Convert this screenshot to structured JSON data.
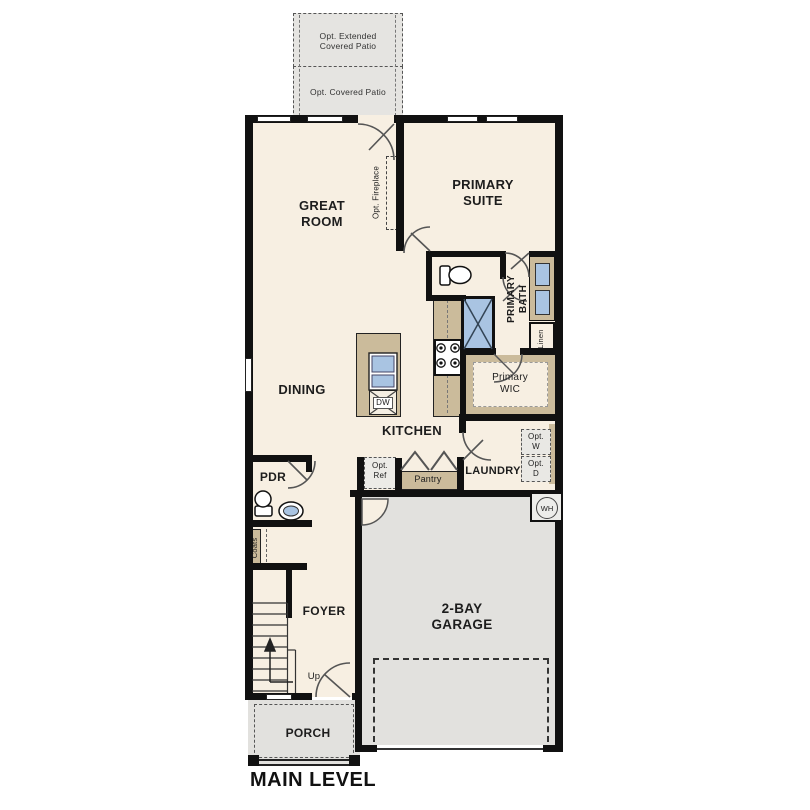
{
  "plan": {
    "level_label": "MAIN LEVEL",
    "colors": {
      "floor": "#f7efe2",
      "outdoor": "#e5e4e1",
      "garage_floor": "#e2e1de",
      "cabinet_tan": "#cbbb9b",
      "fixture_blue": "#a9c4e2",
      "wall": "#111111"
    },
    "patio": {
      "extended_label": "Opt. Extended Covered Patio",
      "covered_label": "Opt. Covered Patio"
    },
    "rooms": {
      "great_room": "GREAT ROOM",
      "primary_suite": "PRIMARY SUITE",
      "primary_bath": "PRIMARY BATH",
      "primary_wic": "Primary WIC",
      "dining": "DINING",
      "kitchen": "KITCHEN",
      "laundry": "LAUNDRY",
      "powder_room": "PDR",
      "foyer": "FOYER",
      "garage": "2-BAY GARAGE",
      "porch": "PORCH"
    },
    "features": {
      "opt_fireplace": "Opt. Fireplace",
      "opt_ref": "Opt. Ref",
      "opt_washer": "Opt. W",
      "opt_dryer": "Opt. D",
      "pantry": "Pantry",
      "linen": "Linen",
      "coats": "Coats",
      "dishwasher": "DW",
      "water_heater": "WH",
      "stairs_up": "Up"
    }
  }
}
